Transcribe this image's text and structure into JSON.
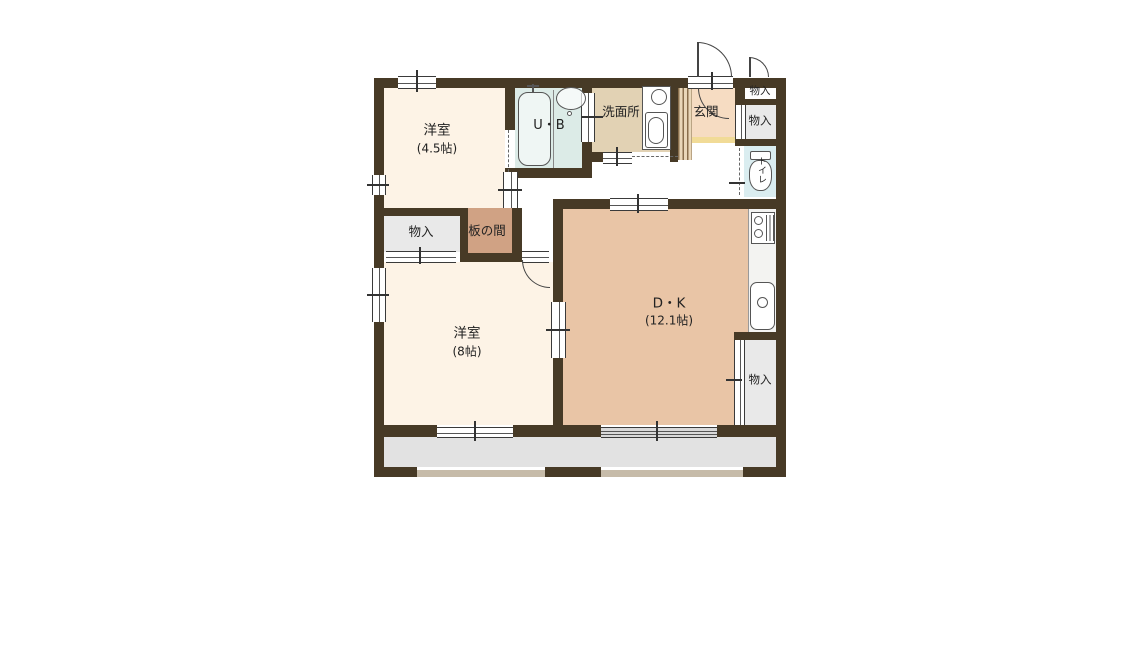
{
  "plan_type": "floor-plan",
  "rooms": {
    "yoshitsu45": {
      "label": "洋室",
      "size": "(4.5帖)"
    },
    "ub": {
      "label": "U・B"
    },
    "senmenjo": {
      "label": "洗面所"
    },
    "genkan": {
      "label": "玄関"
    },
    "monoire_top": {
      "label": "物入"
    },
    "monoire_right": {
      "label": "物入"
    },
    "toilet": {
      "label": "トイレ"
    },
    "monoire_left": {
      "label": "物入"
    },
    "itanoma": {
      "label": "板の間"
    },
    "yoshitsu8": {
      "label": "洋室",
      "size": "(8帖)"
    },
    "dk": {
      "label": "D・K",
      "size": "(12.1帖)"
    },
    "monoire_bottom": {
      "label": "物入"
    }
  },
  "colors": {
    "wall": "#473a26",
    "western_room": "#fdf3e6",
    "unit_bath": "#dcebe7",
    "washroom": "#e2d2b4",
    "entrance": "#f6dcc2",
    "entrance_step": "#f1db97",
    "toilet": "#daedf0",
    "wood_floor": "#d0a284",
    "dining_kitchen": "#e9c5a6",
    "storage": "#e9e9e9",
    "balcony": "#e2e2e2",
    "railing": "#c6bba9"
  }
}
